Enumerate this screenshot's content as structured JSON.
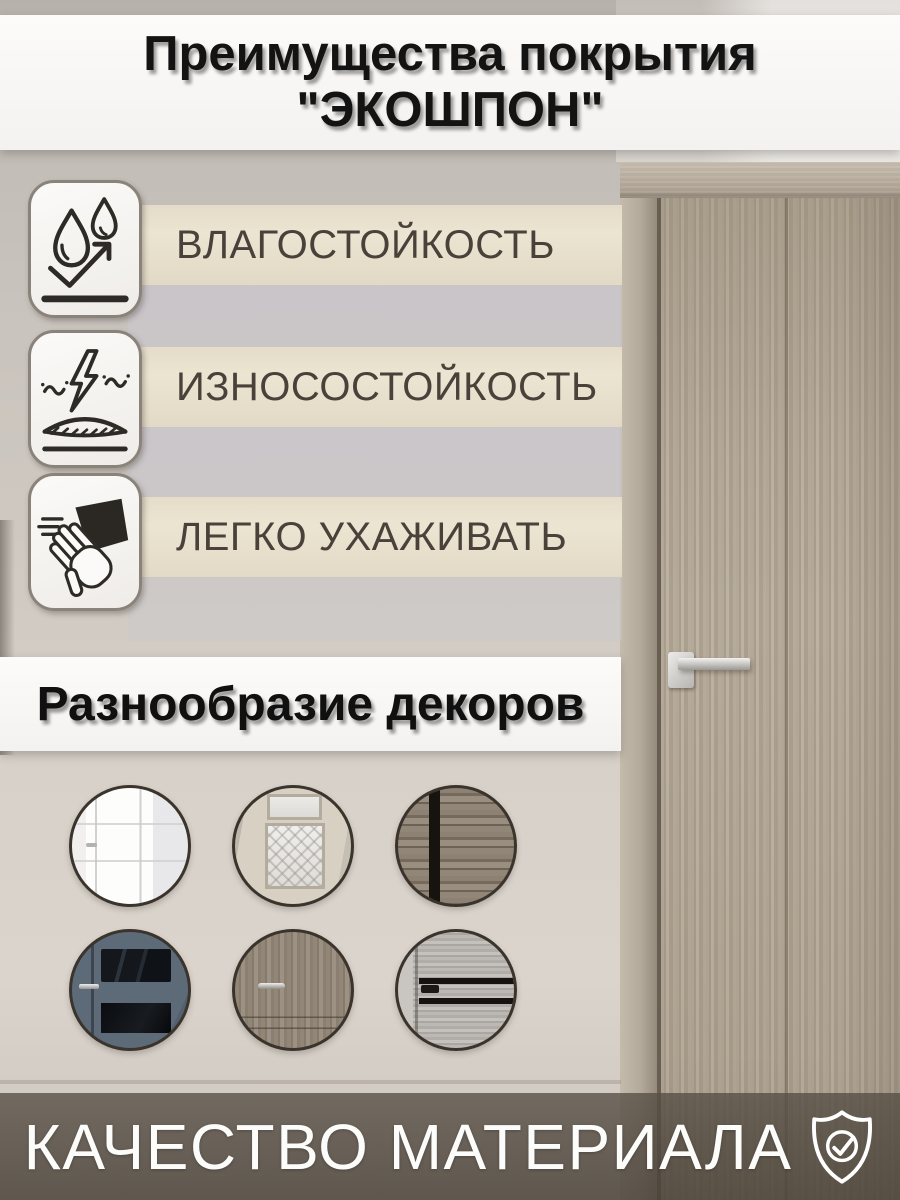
{
  "title": {
    "line1": "Преимущества покрытия",
    "line2": "\"ЭКОШПОН\""
  },
  "features": [
    {
      "label": "ВЛАГОСТОЙКОСТЬ",
      "icon": "water-drops-icon"
    },
    {
      "label": "ИЗНОСОСТОЙКОСТЬ",
      "icon": "wear-resistance-icon"
    },
    {
      "label": "ЛЕГКО УХАЖИВАТЬ",
      "icon": "wipe-clean-icon"
    }
  ],
  "decors": {
    "heading": "Разнообразие декоров",
    "items": [
      "white-classic-panel-door",
      "beige-door-glass-lattice",
      "dark-rustic-plank",
      "slate-blue-black-glass-door",
      "taupe-wood-door-handle",
      "gray-wood-black-stripes-door"
    ]
  },
  "footer": {
    "label": "КАЧЕСТВО МАТЕРИАЛА",
    "icon": "shield-check-icon"
  },
  "colors": {
    "stripe_beige": "#e9e1cd",
    "stripe_gray": "#c9c7ce",
    "banner_white": "#f8f7f5",
    "footer_band": "#7b7267",
    "feature_text": "#4a423a",
    "title_text": "#131313",
    "footer_text": "#fcfcfb",
    "icon_stroke": "#2e2a25",
    "circle_ring": "#3b342c",
    "door_wood": "#b0a595"
  }
}
